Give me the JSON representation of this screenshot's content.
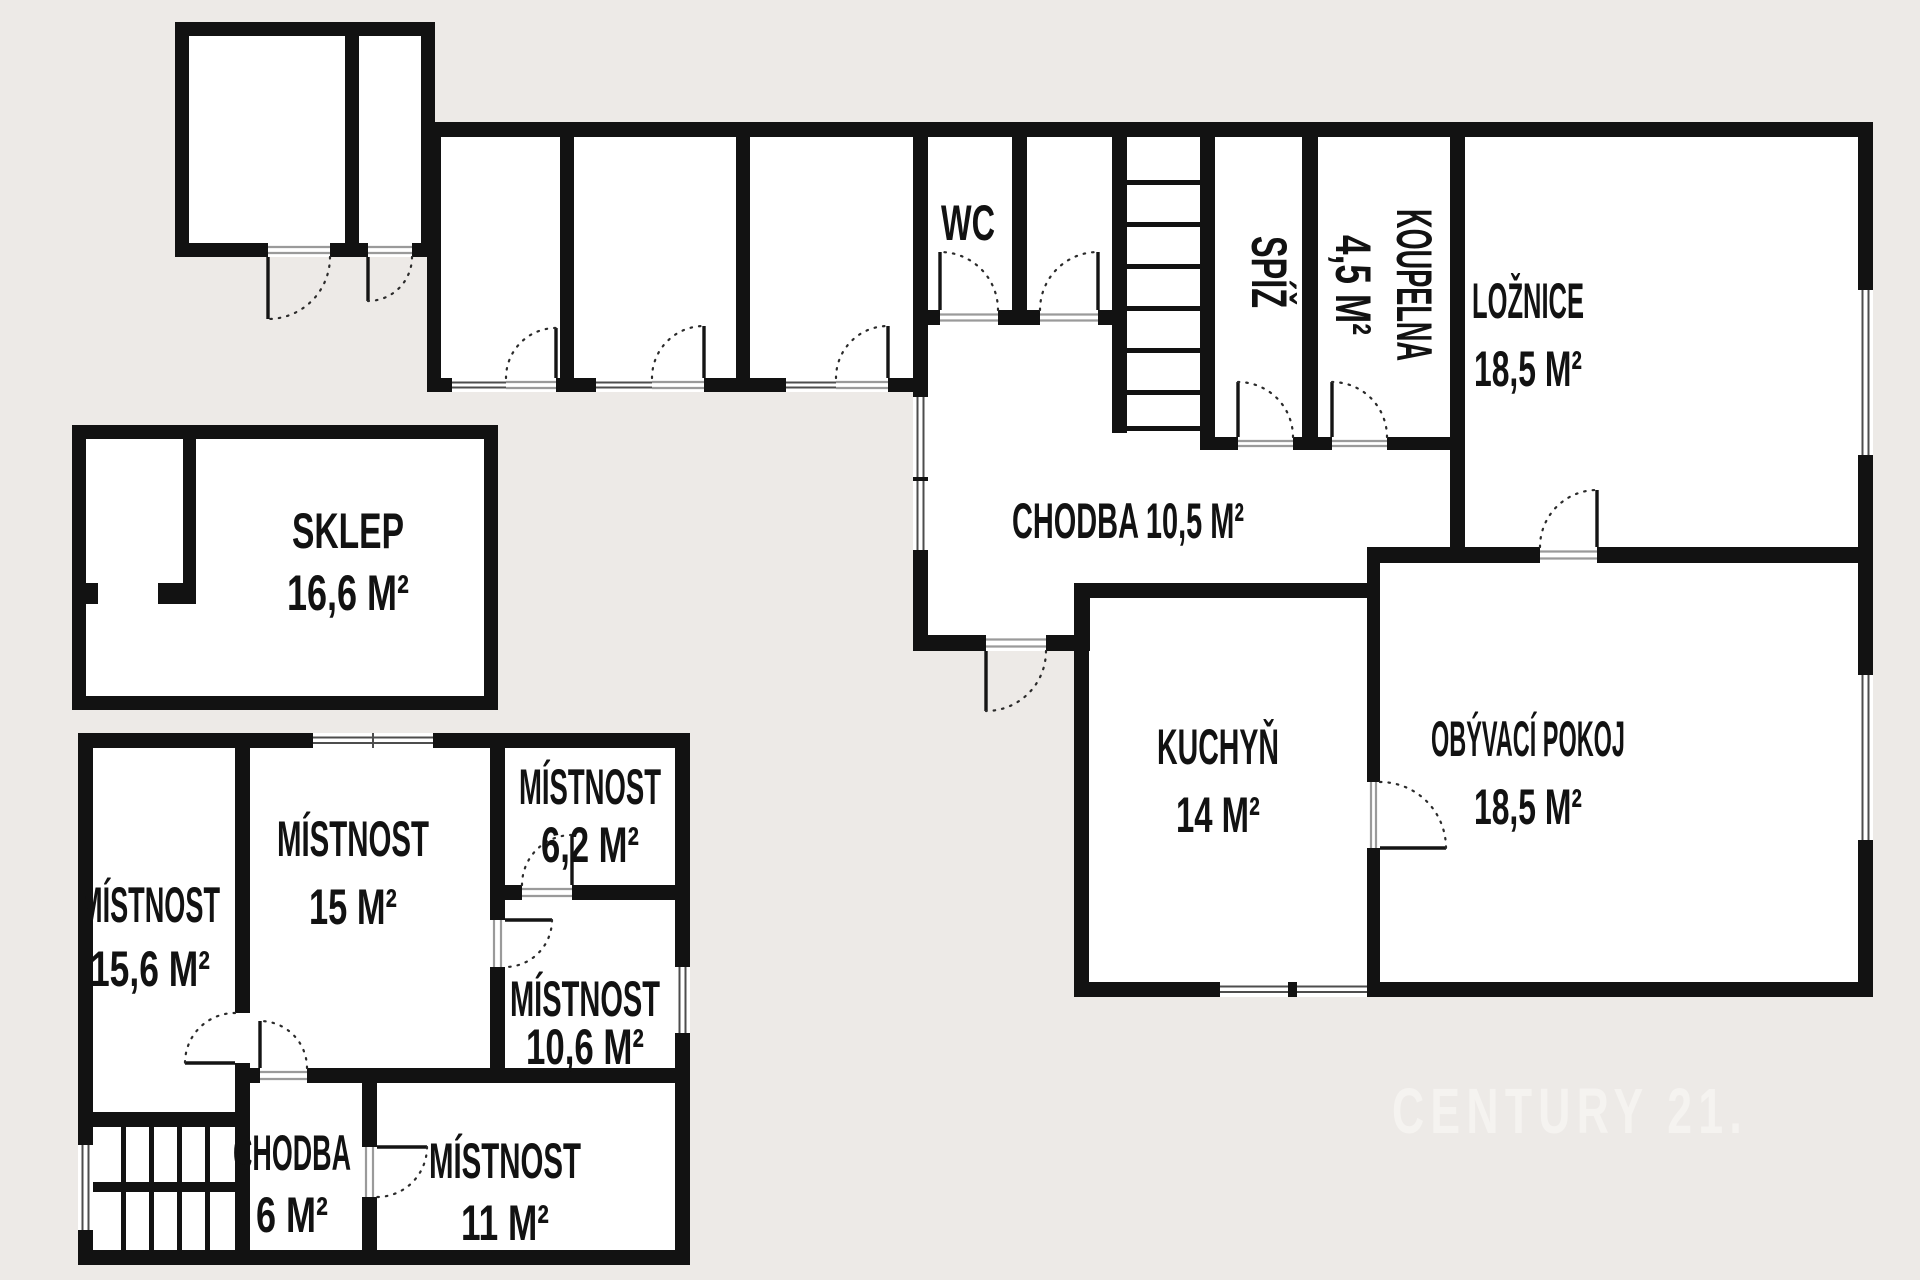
{
  "plan": {
    "watermark": "CENTURY 21.",
    "colors": {
      "background": "#edeae7",
      "wall": "#121212",
      "room_fill": "#ffffff",
      "watermark": "#f5f3f0"
    },
    "rooms": {
      "sklep": {
        "name": "SKLEP",
        "area": "16,6 M²"
      },
      "wc": {
        "name": "WC"
      },
      "spiz": {
        "name": "SPÍŽ"
      },
      "koupelna": {
        "name": "KOUPELNA",
        "area": "4,5 M²"
      },
      "loznice": {
        "name": "LOŽNICE",
        "area": "18,5 M²"
      },
      "chodba": {
        "label": "CHODBA 10,5 M²"
      },
      "kuchyn": {
        "name": "KUCHYŇ",
        "area": "14 M²"
      },
      "obyvaci_pokoj": {
        "name": "OBÝVACÍ POKOJ",
        "area": "18,5 M²"
      },
      "mistnost_15_6": {
        "name": "MÍSTNOST",
        "area": "15,6 M²"
      },
      "mistnost_15": {
        "name": "MÍSTNOST",
        "area": "15 M²"
      },
      "mistnost_6_2": {
        "name": "MÍSTNOST",
        "area": "6,2 M²"
      },
      "mistnost_10_6": {
        "name": "MÍSTNOST",
        "area": "10,6 M²"
      },
      "mistnost_11": {
        "name": "MÍSTNOST",
        "area": "11 M²"
      },
      "chodba_6": {
        "name": "CHODBA",
        "area": "6 M²"
      }
    }
  }
}
